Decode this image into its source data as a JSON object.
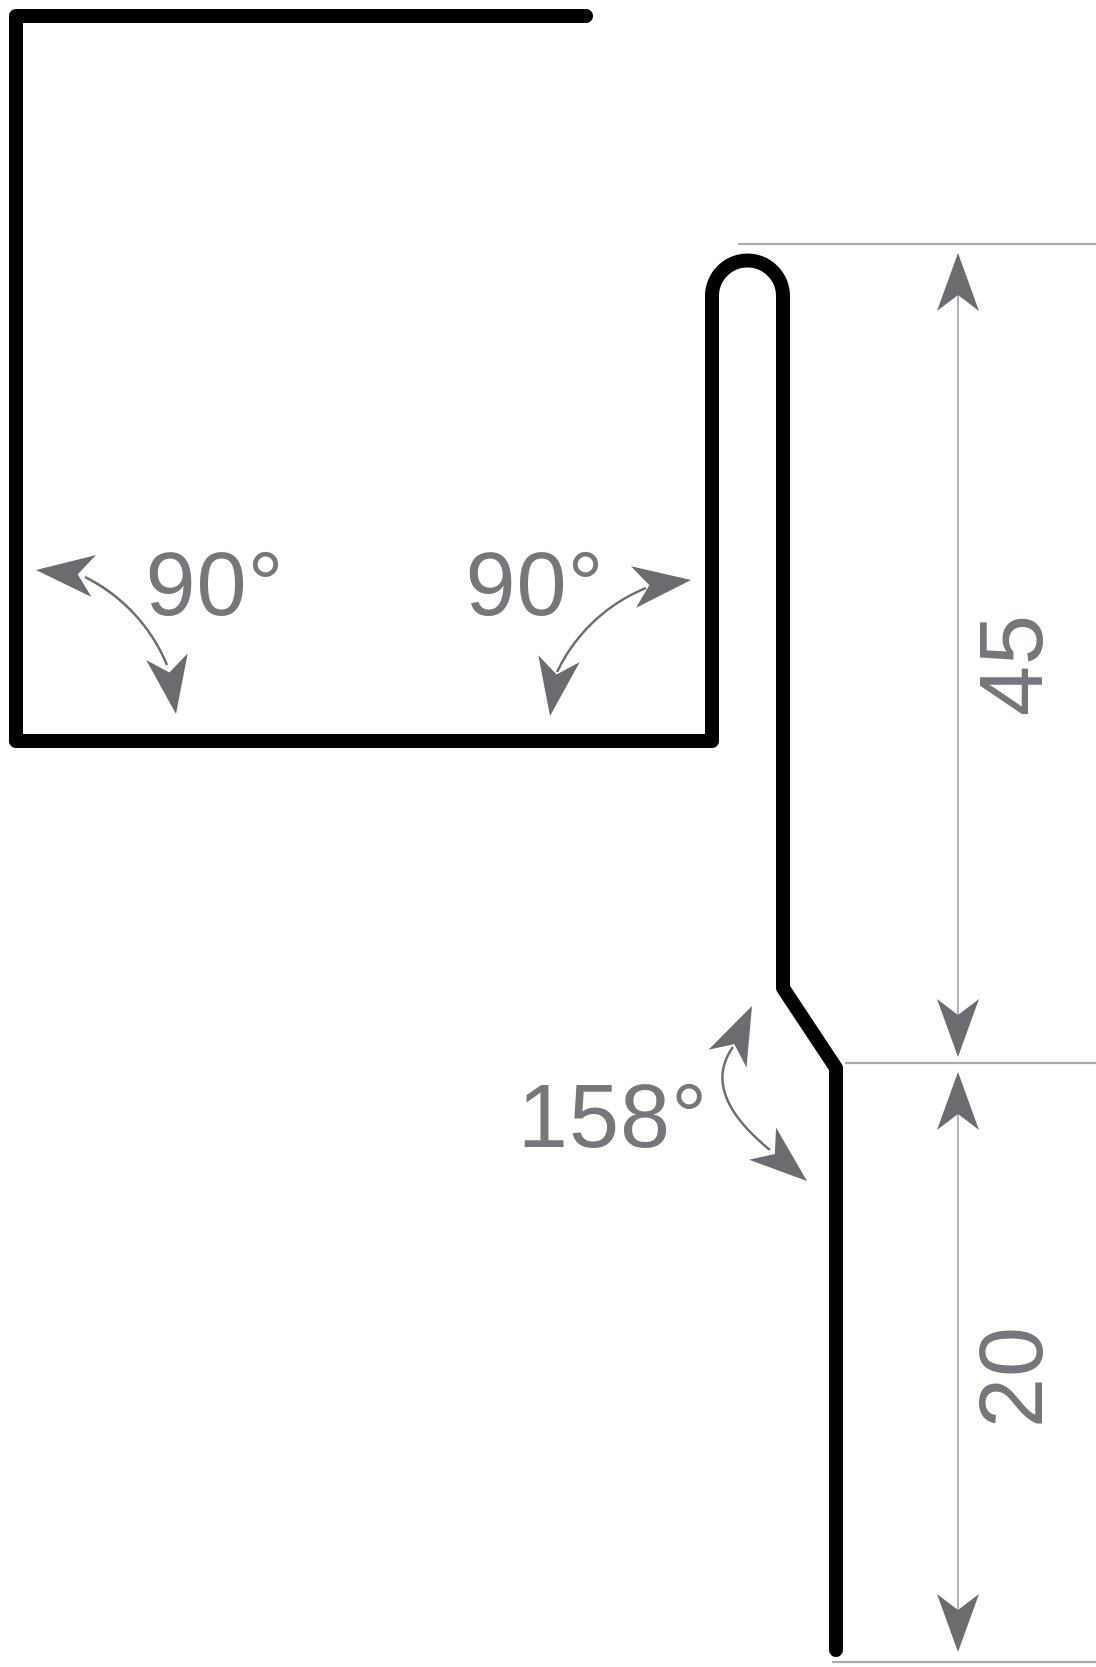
{
  "drawing": {
    "title": "sheet-metal-flashing-profile",
    "angles": {
      "left_label": "90°",
      "right_label": "90°",
      "bend_label": "158°"
    },
    "dimensions": {
      "upright_label": "45",
      "bottom_label": "20"
    }
  },
  "colors": {
    "background": "#ffffff",
    "profile": "#000000",
    "annotation": "#6a6c6f",
    "label": "#76777b",
    "thin_line": "#a9abae"
  }
}
